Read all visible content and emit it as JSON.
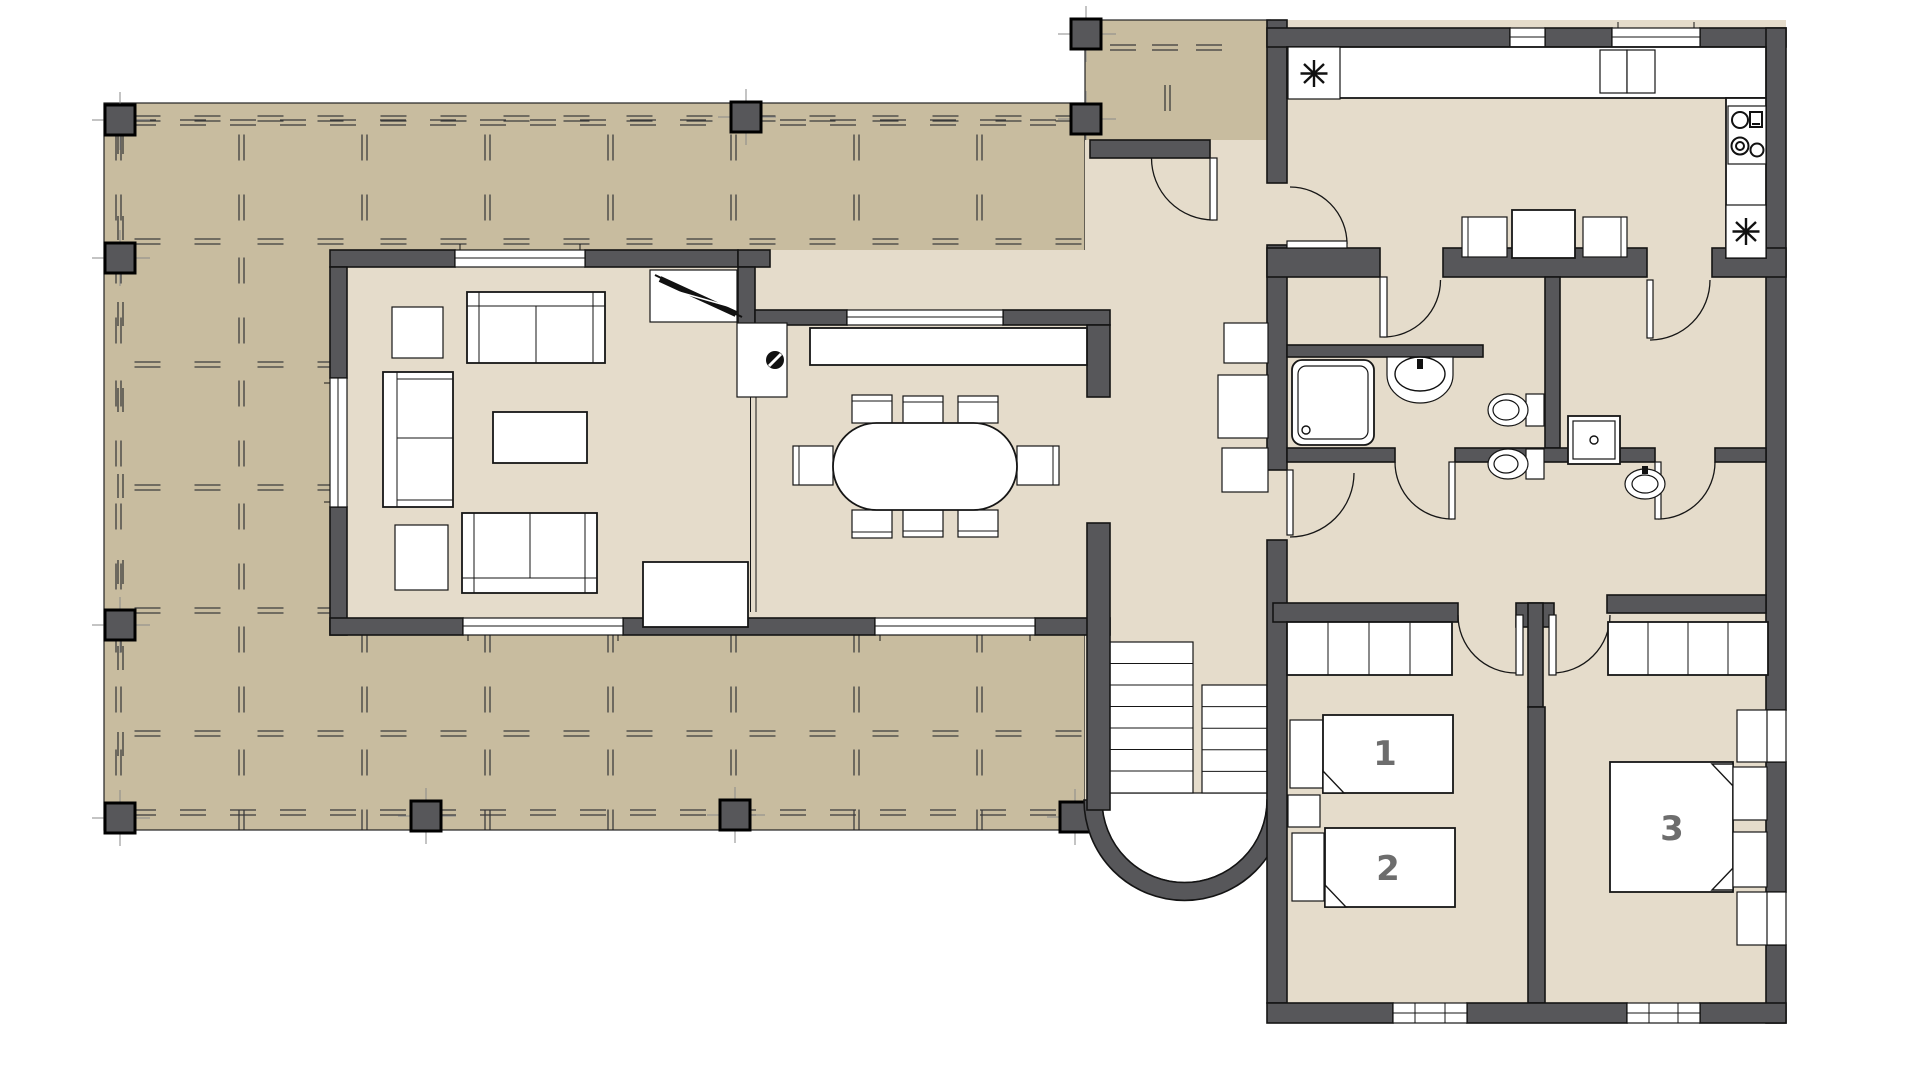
{
  "drawing": {
    "type": "architectural-floor-plan",
    "bedroom_labels": {
      "bed1": "1",
      "bed2": "2",
      "bed3": "3"
    }
  },
  "icons": {
    "sink_symbol": "eight-spoke-asterisk",
    "stove_symbol": "four-burner-cooktop",
    "door_symbol": "quarter-arc-swing",
    "deck_pattern": "double-dash-grid",
    "post_symbol": "square-column-with-axis-ticks"
  },
  "colors": {
    "wall": "#57575a",
    "deck": "#c8bc9f",
    "floor": "#e5dccb",
    "label": "#6d6d6d",
    "furniture": "#ffffff",
    "outline": "#141414"
  }
}
